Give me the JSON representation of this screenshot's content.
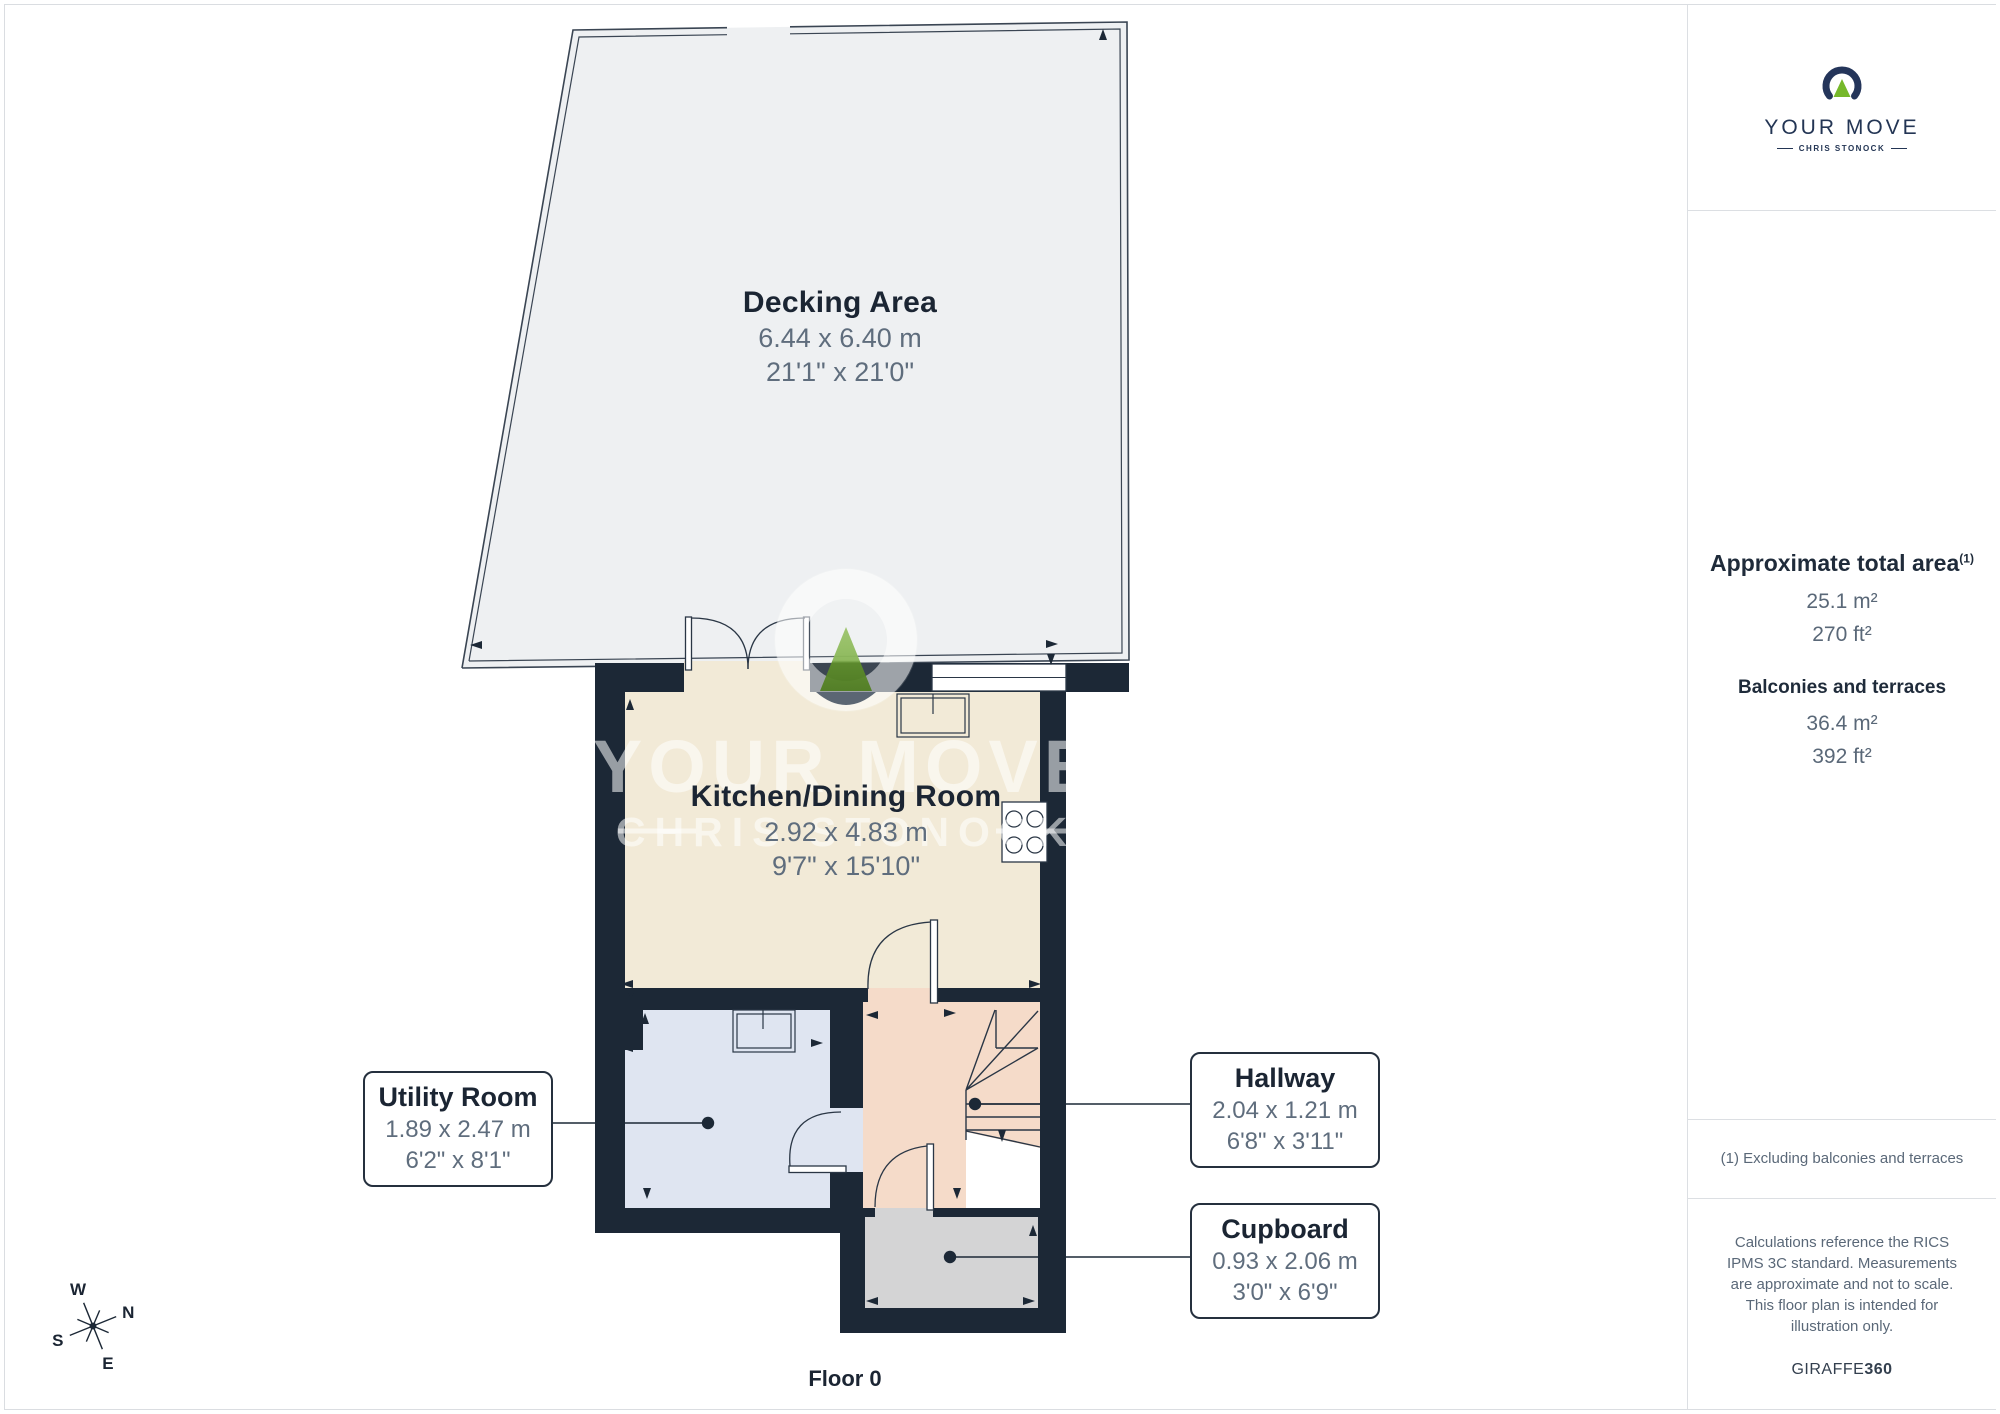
{
  "page": {
    "floor_label": "Floor 0"
  },
  "branding": {
    "logo_title": "YOUR MOVE",
    "logo_subtitle": "CHRIS STONOCK",
    "watermark_line1": "YOUR MOVE",
    "watermark_line2": "CHRIS STONOCK",
    "credit_brand": "GIRAFFE",
    "credit_suffix": "360"
  },
  "sidebar": {
    "total_area": {
      "title": "Approximate total area",
      "superscript": "(1)",
      "metric": "25.1 m²",
      "imperial": "270 ft²"
    },
    "balconies": {
      "title": "Balconies and terraces",
      "metric": "36.4 m²",
      "imperial": "392 ft²"
    },
    "footnote": "(1) Excluding balconies and terraces",
    "disclaimer": "Calculations reference the RICS IPMS 3C standard. Measurements are approximate and not to scale. This floor plan is intended for illustration only."
  },
  "rooms": [
    {
      "name": "Decking Area",
      "metric": "6.44 x 6.40 m",
      "imperial": "21'1\" x 21'0\""
    },
    {
      "name": "Kitchen/Dining Room",
      "metric": "2.92 x 4.83 m",
      "imperial": "9'7\" x 15'10\""
    },
    {
      "name": "Utility Room",
      "metric": "1.89 x 2.47 m",
      "imperial": "6'2\" x 8'1\""
    },
    {
      "name": "Hallway",
      "metric": "2.04 x 1.21 m",
      "imperial": "6'8\" x 3'11\""
    },
    {
      "name": "Cupboard",
      "metric": "0.93 x 2.06 m",
      "imperial": "3'0\" x 6'9\""
    }
  ],
  "compass": {
    "n": "N",
    "s": "S",
    "e": "E",
    "w": "W"
  },
  "colors": {
    "wall": "#1c2836",
    "decking": "#eef0f2",
    "kitchen": "#f2ead7",
    "utility": "#dfe5f1",
    "hallway": "#f5dbc9",
    "cupboard": "#d4d4d5",
    "accent_green": "#76b82a",
    "label_navy": "#1b2533",
    "dim_gray": "#5f6d7d"
  }
}
